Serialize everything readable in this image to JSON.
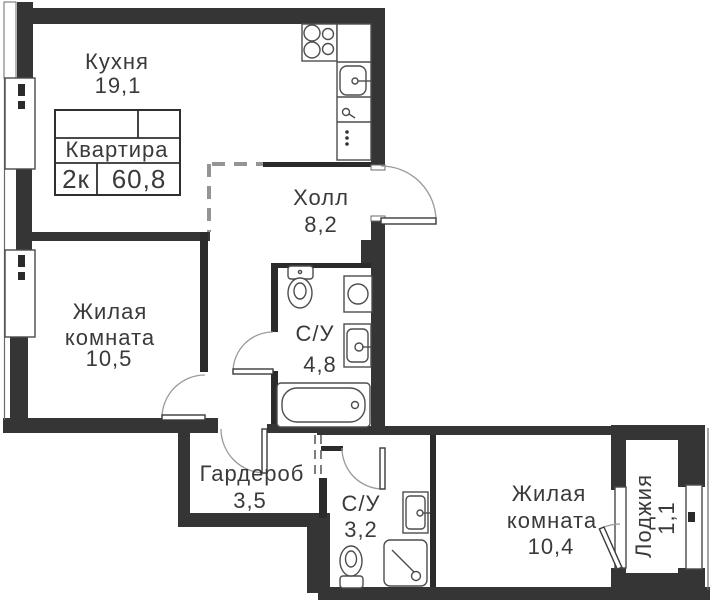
{
  "plan_stamp": {
    "name": "Квартира",
    "rooms_count": "2к",
    "total_area": "60,8"
  },
  "rooms": [
    {
      "key": "kitchen",
      "label_lines": [
        "Кухня"
      ],
      "area": "19,1"
    },
    {
      "key": "hall",
      "label_lines": [
        "Холл"
      ],
      "area": "8,2"
    },
    {
      "key": "living-room-1",
      "label_lines": [
        "Жилая",
        "комната"
      ],
      "area": "10,5"
    },
    {
      "key": "bathroom-1",
      "label_lines": [
        "С/У"
      ],
      "area": "4,8"
    },
    {
      "key": "wardrobe",
      "label_lines": [
        "Гардероб"
      ],
      "area": "3,5"
    },
    {
      "key": "bathroom-2",
      "label_lines": [
        "С/У"
      ],
      "area": "3,2"
    },
    {
      "key": "living-room-2",
      "label_lines": [
        "Жилая",
        "комната"
      ],
      "area": "10,4"
    },
    {
      "key": "loggia",
      "label_lines": [
        "Лоджия"
      ],
      "area": "1,1"
    }
  ],
  "fixtures": [
    "stove",
    "kitchen-sink",
    "dishwasher-dots",
    "toilet",
    "washing-machine",
    "washbasin",
    "bathtub",
    "shower",
    "balcony-door"
  ],
  "colors": {
    "wall": "#353535",
    "fixture_line": "#4d4d4d",
    "text": "#3a3a3a",
    "door_arc": "#9a9a9a",
    "background": "#ffffff"
  }
}
